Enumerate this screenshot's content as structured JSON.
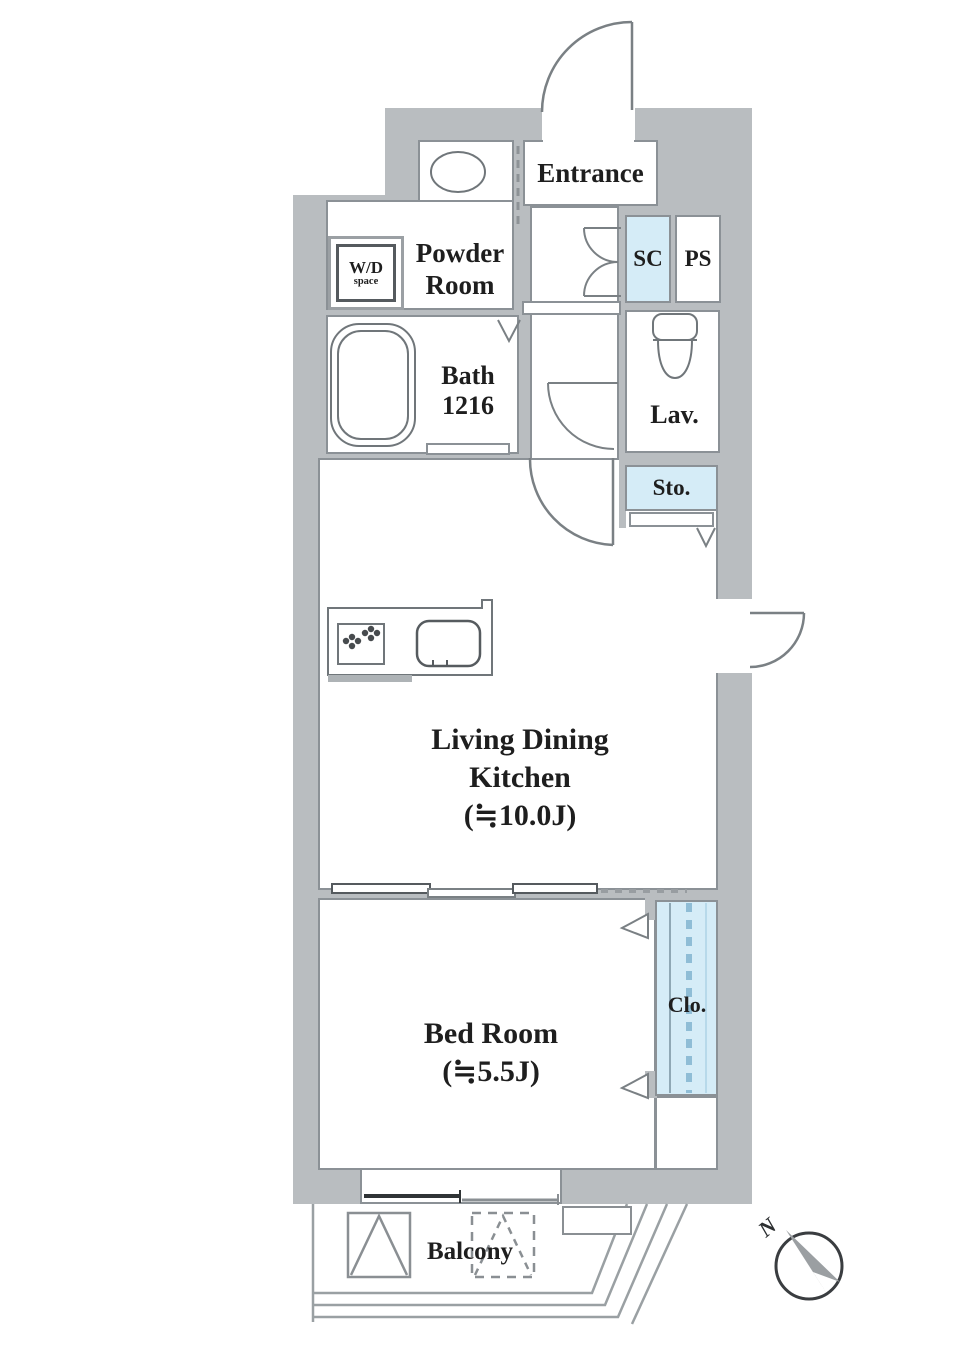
{
  "plan_title": "1K apartment floor plan",
  "colors": {
    "wall_gray": "#b9bdc0",
    "room_white": "#ffffff",
    "highlight_blue": "#d5ecf7",
    "border_line": "#8b9196",
    "door_line": "#7a8084",
    "text": "#1e1e1e"
  },
  "rooms": {
    "entrance": {
      "label": "Entrance"
    },
    "powder_room": {
      "line1": "Powder",
      "line2": "Room"
    },
    "wd_space": {
      "line1": "W/D",
      "line2": "space"
    },
    "bath": {
      "line1": "Bath",
      "line2": "1216"
    },
    "shoe_closet": {
      "label": "SC"
    },
    "pipe_space": {
      "label": "PS"
    },
    "lavatory": {
      "label": "Lav."
    },
    "storage": {
      "label": "Sto."
    },
    "living_dining_kitchen": {
      "line1": "Living Dining",
      "line2": "Kitchen",
      "line3": "(≒10.0J)"
    },
    "bedroom": {
      "line1": "Bed Room",
      "line2": "(≒5.5J)"
    },
    "closet": {
      "label": "Clo."
    },
    "balcony": {
      "label": "Balcony"
    }
  },
  "compass": {
    "label": "N"
  },
  "fixtures": [
    "entrance-door",
    "washbasin",
    "bathtub",
    "toilet",
    "gas-stove",
    "kitchen-sink",
    "sliding-window",
    "closet-sliding-door",
    "balcony-ac-unit",
    "balcony-future-unit",
    "north-compass"
  ]
}
